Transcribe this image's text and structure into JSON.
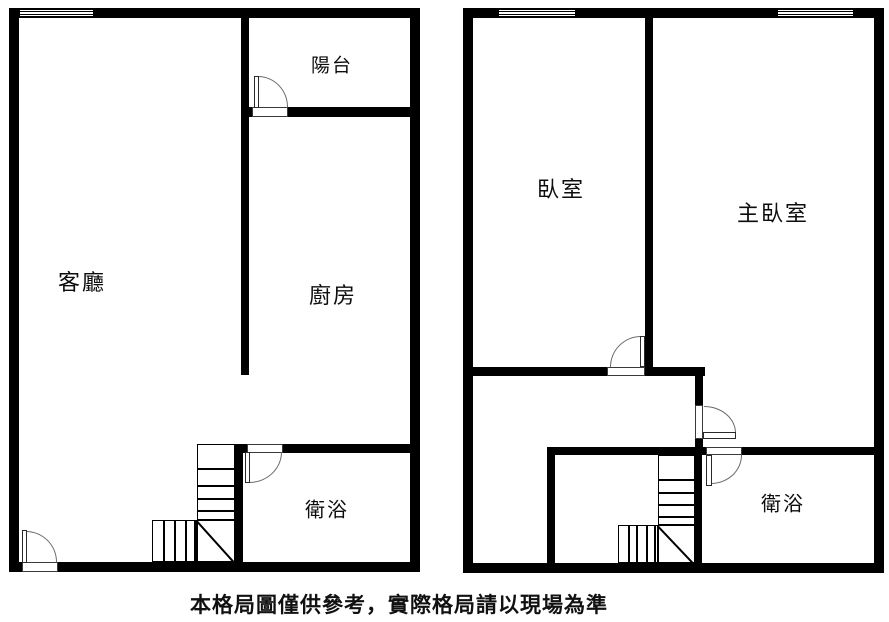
{
  "canvas": {
    "width": 889,
    "height": 622,
    "background": "#ffffff",
    "line_color": "#000000"
  },
  "caption": {
    "text": "本格局圖僅供參考，實際格局請以現場為準"
  },
  "plans": {
    "left": {
      "rooms": {
        "balcony": {
          "label": "陽台"
        },
        "living_room": {
          "label": "客廳"
        },
        "kitchen": {
          "label": "廚房"
        },
        "bathroom": {
          "label": "衛浴"
        }
      },
      "features": [
        "entrance-door",
        "balcony-door",
        "bathroom-door",
        "l-shaped-stairs",
        "window-top-left"
      ]
    },
    "right": {
      "rooms": {
        "bedroom": {
          "label": "臥室"
        },
        "master_bedroom": {
          "label": "主臥室"
        },
        "bathroom": {
          "label": "衛浴"
        }
      },
      "features": [
        "bedroom-door",
        "master-bedroom-door",
        "bathroom-door",
        "l-shaped-stairs",
        "window-bedroom",
        "window-master-bedroom"
      ]
    }
  }
}
